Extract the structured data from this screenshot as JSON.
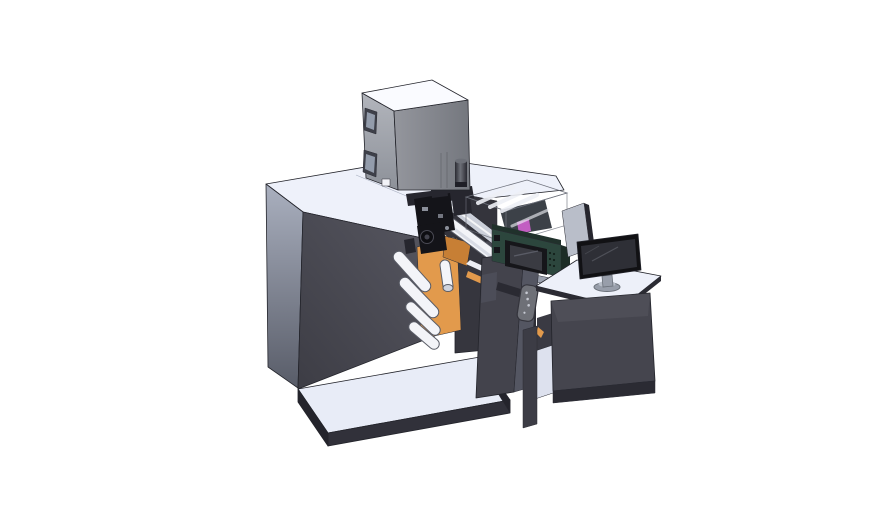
{
  "scene": {
    "background": "#ffffff"
  },
  "parts": {
    "platform": "Machine base platform",
    "cabinet": "Main machine cabinet",
    "supply_box": "Top supply box",
    "post": "Support post",
    "step": "Side step panel",
    "mechanism": "Print head mechanism",
    "rollers": "Web guide rollers",
    "web": "Label web path",
    "rail": "Guide rail cover",
    "acrylic": "Transparent safety cover",
    "control": "Control panel module",
    "column": "Output support column",
    "remote": "Handheld pendant",
    "desk": "Operator desk",
    "side_panel": "Desk side panel",
    "monitor": "Desktop monitor"
  },
  "colors": {
    "bg": "#ffffff",
    "cab_top": "#eef1fa",
    "cab_front_a": "#575761",
    "cab_front_b": "#3d3d45",
    "cab_left_a": "#aab0bf",
    "cab_left_b": "#585c68",
    "seam": "#a6adbe",
    "step_face": "#36363e",
    "step_edge": "#4a4a54",
    "plat_top": "#e8ecf7",
    "plat_front": "#31313a",
    "plat_side": "#24242c",
    "box_top": "#fafbff",
    "box_front_a": "#94969d",
    "box_front_b": "#74777e",
    "box_left_a": "#b2b5bc",
    "box_left_b": "#8d9199",
    "box_window": "#3e4049",
    "box_window_inner": "#939cab",
    "box_square": "#f2f3f7",
    "cyl_a": "#6d7078",
    "cyl_b": "#2a2a32",
    "cyl_band": "#1f1f27",
    "roller_fill": "#f3f4f8",
    "roller_stroke": "#5a5d67",
    "roller_shade": "#cfd3dd",
    "orange": "#e29a4c",
    "orange_dark": "#c77f35",
    "rail": "#ccd0da",
    "rail_hi": "#ffffff",
    "mech_dark": "#141419",
    "mech_mid": "#26262e",
    "mech_deep": "#0e0e12",
    "mech_hi": "#8b8f9a",
    "module_dark": "#34343c",
    "acr_top": "#dfe4ef",
    "acr_front": "#c7cdda",
    "acr_left": "#b3bac9",
    "strut": "#eef0f6",
    "purple": "#c25ec2",
    "inner_dark": "#3c4148",
    "green_face": "#2c463d",
    "green_dark": "#20312b",
    "green_side": "#1c2c26",
    "green_btn": "#15151a",
    "green_dot": "#13201a",
    "bezel": "#16161a",
    "screen_face": "#3a3b42",
    "glare": "#5a5c66",
    "bed_light": "#9ba1ae",
    "bed_dark": "#2d2d35",
    "web_white": "#eceef4",
    "col_front": "#43434c",
    "col_side": "#545662",
    "arm_dark": "#2a2a32",
    "remote": "#6e7077",
    "remote_stroke": "#34343c",
    "remote_dot": "#c6c9d2",
    "panel_face": "#b9bec9",
    "panel_edge_dark": "#26262e",
    "desk_top": "#edf0f9",
    "desk_front": "#45454e",
    "desk_base": "#2b2b33",
    "shelf_floor": "#dde1ee",
    "shelf_back": "#3a3a43",
    "leg": "#3c3c45",
    "mon_bezel": "#111114",
    "mon_face": "#2e2f36",
    "mon_glare": "#4e5058",
    "stand": "#989eaa",
    "stand_dark": "#6a7079",
    "stand_hi": "#b8bec8",
    "white": "#ffffff"
  }
}
